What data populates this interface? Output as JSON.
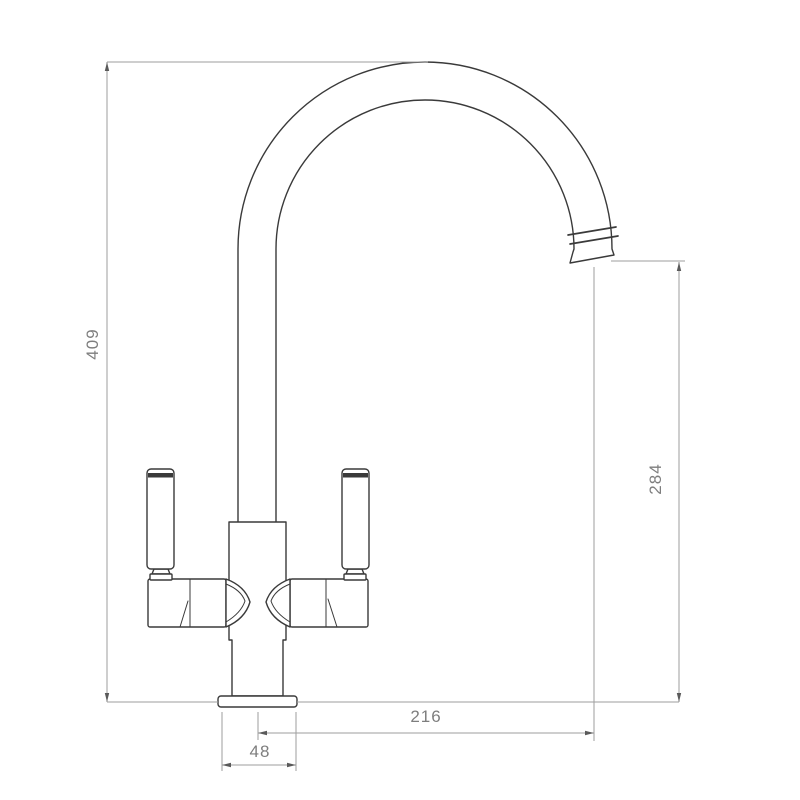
{
  "diagram": {
    "background_color": "#ffffff",
    "outline_color": "#3a3a3a",
    "dimension_line_color": "#9e9e9e",
    "label_color": "#7e7e7e",
    "labels": {
      "overall_height": "409",
      "spout_outlet_height": "284",
      "spout_reach": "216",
      "base_width": "48"
    }
  }
}
